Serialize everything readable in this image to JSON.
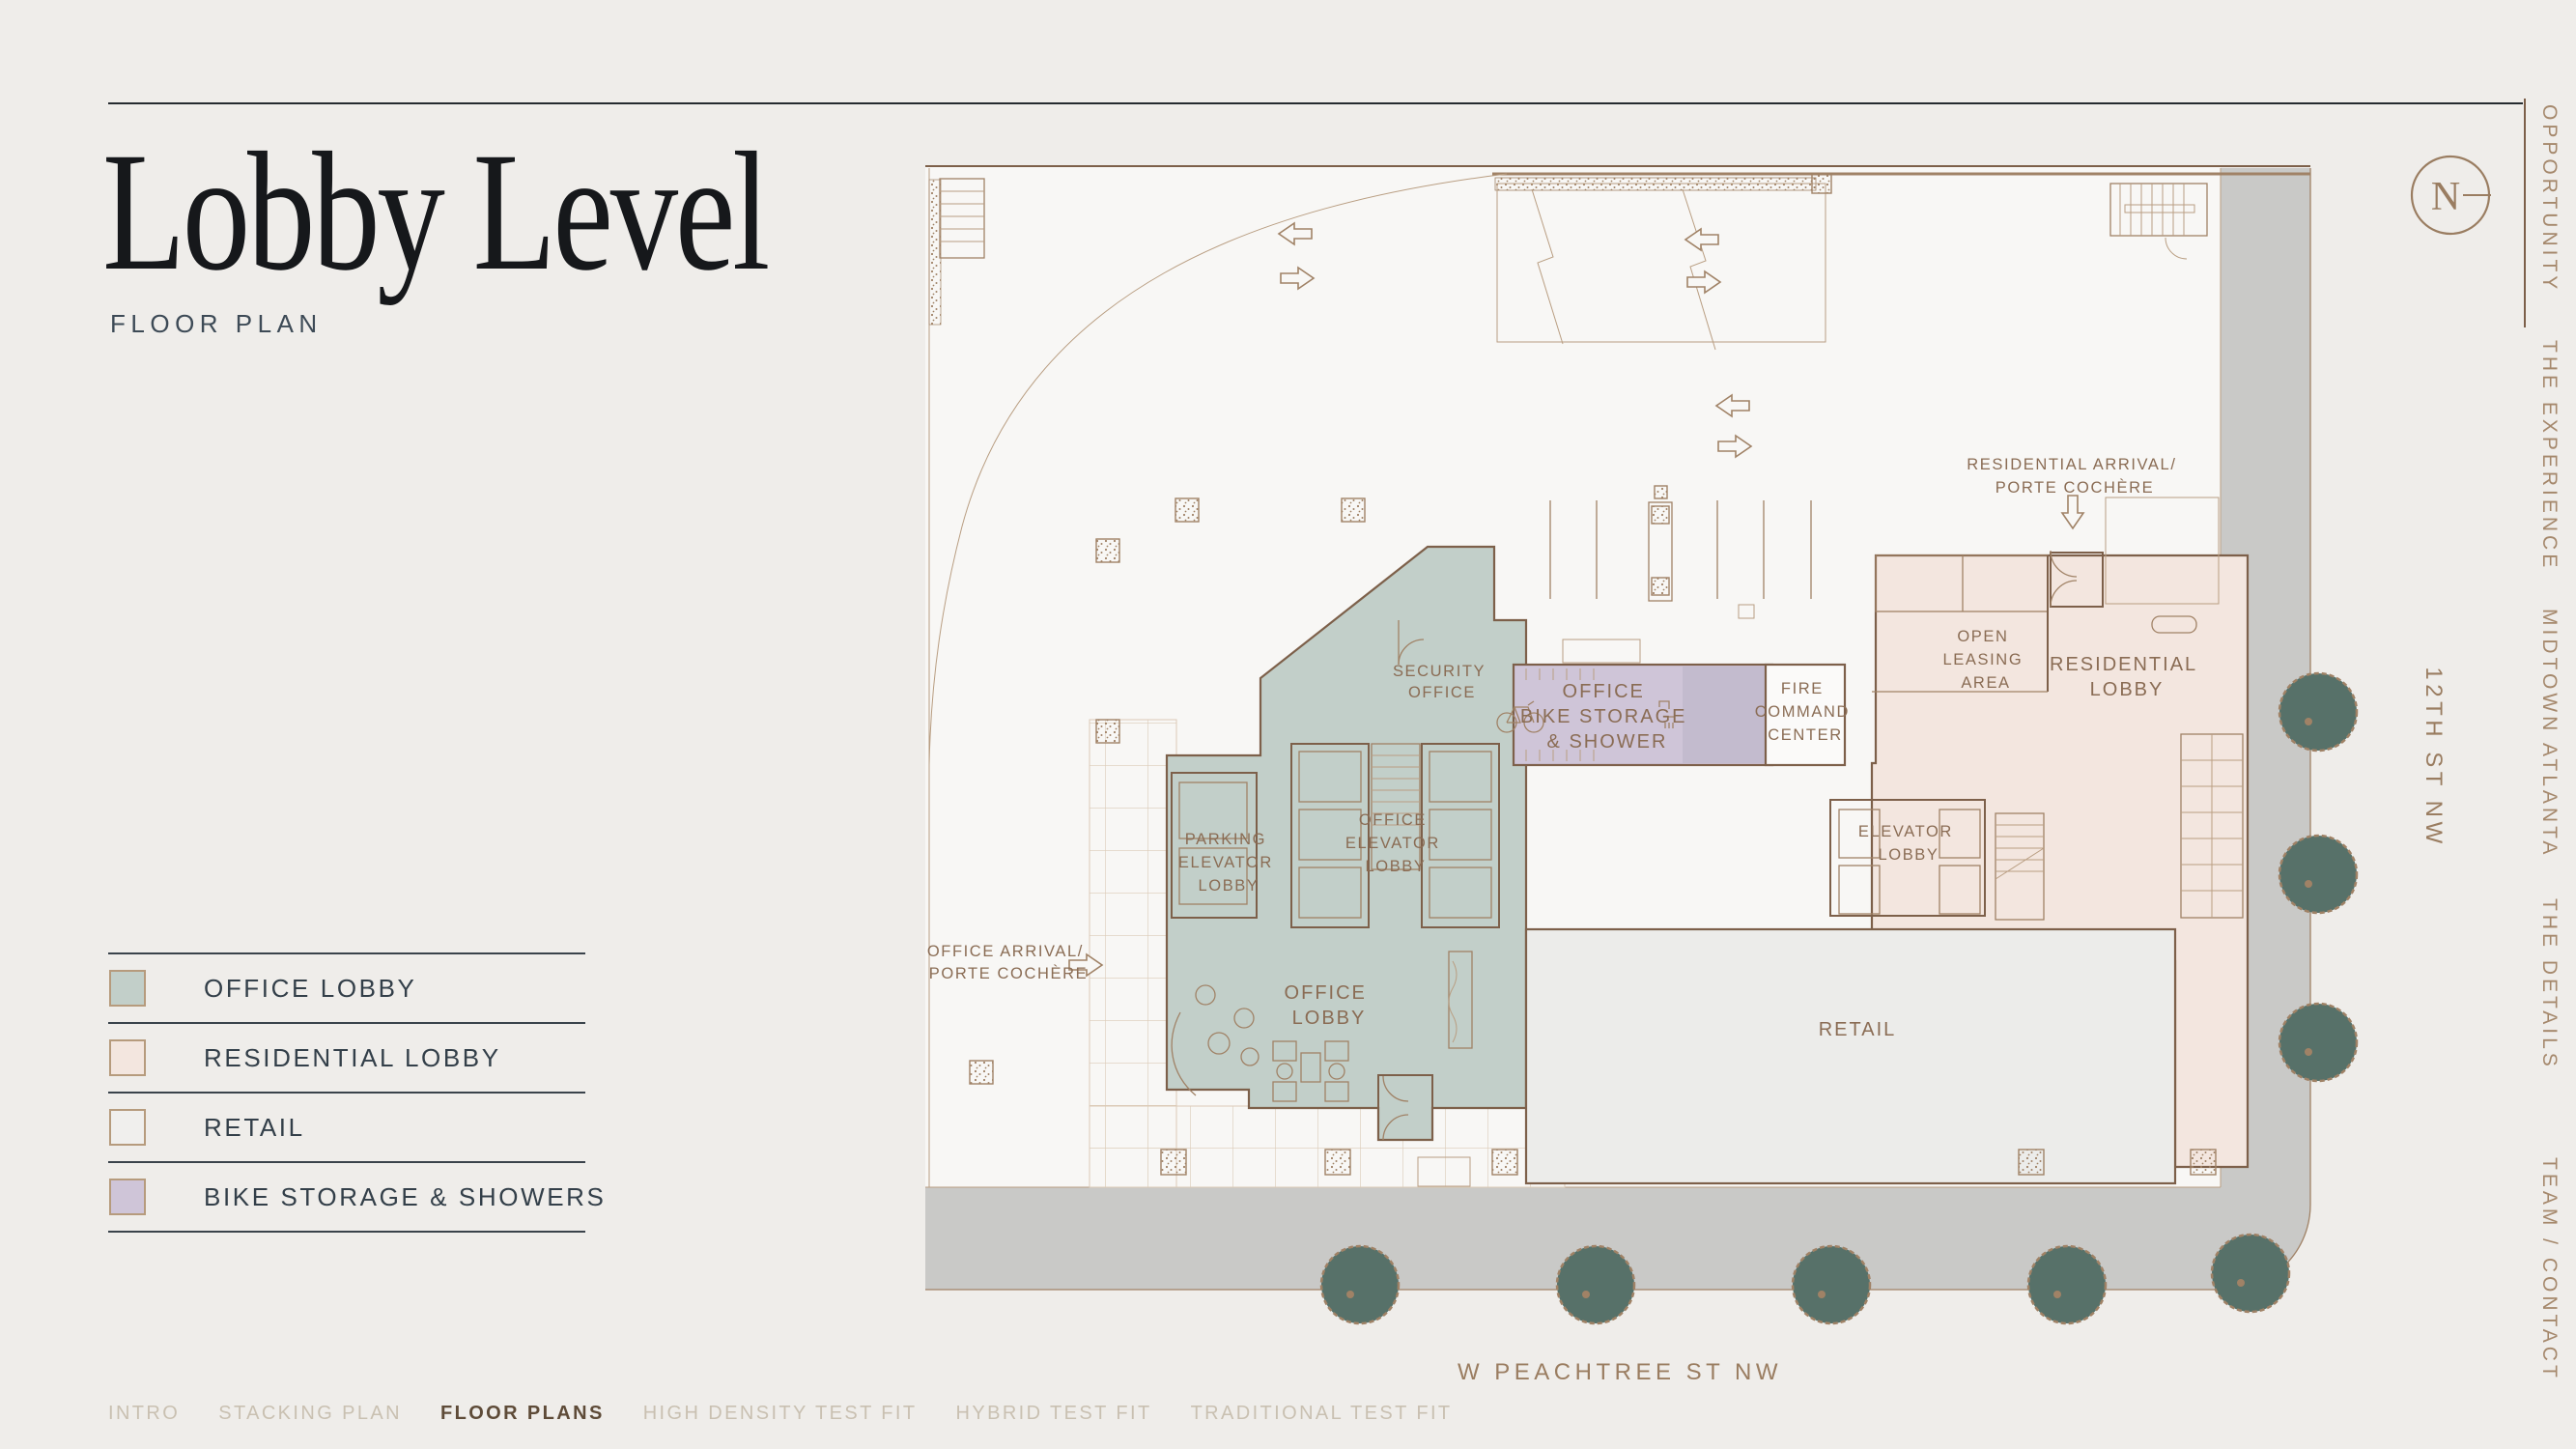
{
  "page": {
    "title": "Lobby Level",
    "subtitle": "FLOOR PLAN"
  },
  "legend": {
    "items": [
      {
        "label": "OFFICE LOBBY",
        "color": "#c2cfc9"
      },
      {
        "label": "RESIDENTIAL LOBBY",
        "color": "#f3e6df"
      },
      {
        "label": "RETAIL",
        "color": "#f0efed"
      },
      {
        "label": "BIKE STORAGE & SHOWERS",
        "color": "#cfc5d8"
      }
    ]
  },
  "bottom_nav": {
    "items": [
      {
        "label": "INTRO",
        "active": false
      },
      {
        "label": "STACKING PLAN",
        "active": false
      },
      {
        "label": "FLOOR PLANS",
        "active": true
      },
      {
        "label": "HIGH DENSITY TEST FIT",
        "active": false
      },
      {
        "label": "HYBRID TEST FIT",
        "active": false
      },
      {
        "label": "TRADITIONAL TEST FIT",
        "active": false
      }
    ]
  },
  "side_nav": {
    "items": [
      {
        "label": "OPPORTUNITY",
        "active": true
      },
      {
        "label": "THE EXPERIENCE",
        "active": false
      },
      {
        "label": "MIDTOWN ATLANTA",
        "active": false
      },
      {
        "label": "THE DETAILS",
        "active": false
      },
      {
        "label": "TEAM / CONTACT",
        "active": false
      }
    ]
  },
  "plan": {
    "north_label": "N",
    "streets": {
      "south": "W PEACHTREE ST NW",
      "east": "12TH ST NW"
    },
    "colors": {
      "office": "#c2cfc9",
      "residential": "#f3e6df",
      "retail": "#ececea",
      "bike": "#cfc5d8",
      "shower_room": "#c3bbce",
      "road": "#c9c9c7",
      "tree": "#577169",
      "paper": "#f8f7f5",
      "room_white": "#fbfaf9"
    },
    "labels": {
      "security_office": {
        "lines": [
          "SECURITY",
          "OFFICE"
        ]
      },
      "bike_storage": {
        "lines": [
          "OFFICE",
          "BIKE STORAGE",
          "& SHOWER"
        ]
      },
      "fire_command": {
        "lines": [
          "FIRE",
          "COMMAND",
          "CENTER"
        ]
      },
      "open_leasing": {
        "lines": [
          "OPEN",
          "LEASING",
          "AREA"
        ]
      },
      "residential_lobby": {
        "lines": [
          "RESIDENTIAL",
          "LOBBY"
        ]
      },
      "parking_elevator": {
        "lines": [
          "PARKING",
          "ELEVATOR",
          "LOBBY"
        ]
      },
      "office_elevator": {
        "lines": [
          "OFFICE",
          "ELEVATOR",
          "LOBBY"
        ]
      },
      "office_lobby": {
        "lines": [
          "OFFICE",
          "LOBBY"
        ]
      },
      "elevator_lobby": {
        "lines": [
          "ELEVATOR",
          "LOBBY"
        ]
      },
      "retail": {
        "lines": [
          "RETAIL"
        ]
      },
      "residential_arrival": {
        "lines": [
          "RESIDENTIAL ARRIVAL/",
          "PORTE COCHÈRE"
        ]
      },
      "office_arrival": {
        "lines": [
          "OFFICE ARRIVAL/",
          "PORTE COCHÈRE"
        ]
      }
    }
  }
}
